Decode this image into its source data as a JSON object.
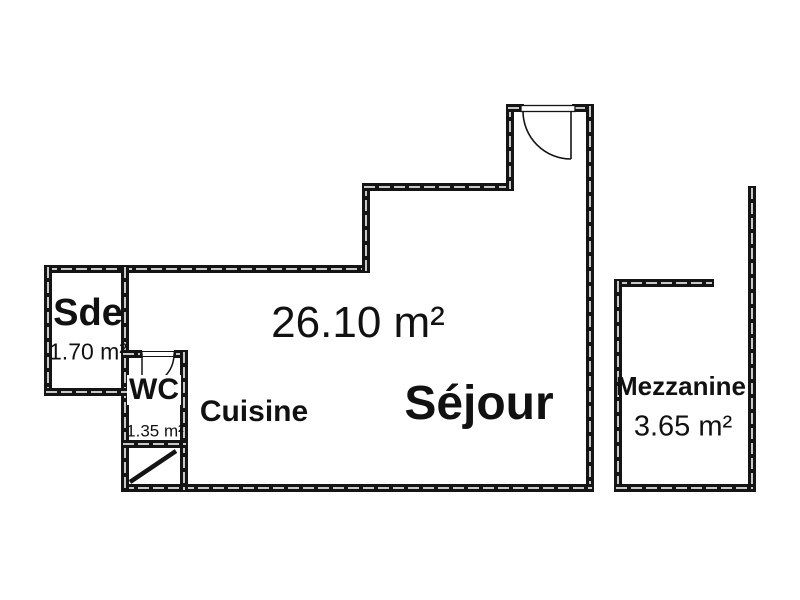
{
  "plan": {
    "rooms": {
      "sde": {
        "label": "Sde",
        "area": "1.70 m²"
      },
      "wc": {
        "label": "WC",
        "area": "1.35 m²"
      },
      "cuisine": {
        "label": "Cuisine"
      },
      "sejour": {
        "label": "Séjour",
        "area": "26.10 m²"
      },
      "mezzanine": {
        "label": "Mezzanine",
        "area": "3.65 m²"
      }
    },
    "colors": {
      "wall": "#141414",
      "wall_hatch": "#c9c9c9",
      "background": "#ffffff",
      "text": "#111111"
    }
  }
}
